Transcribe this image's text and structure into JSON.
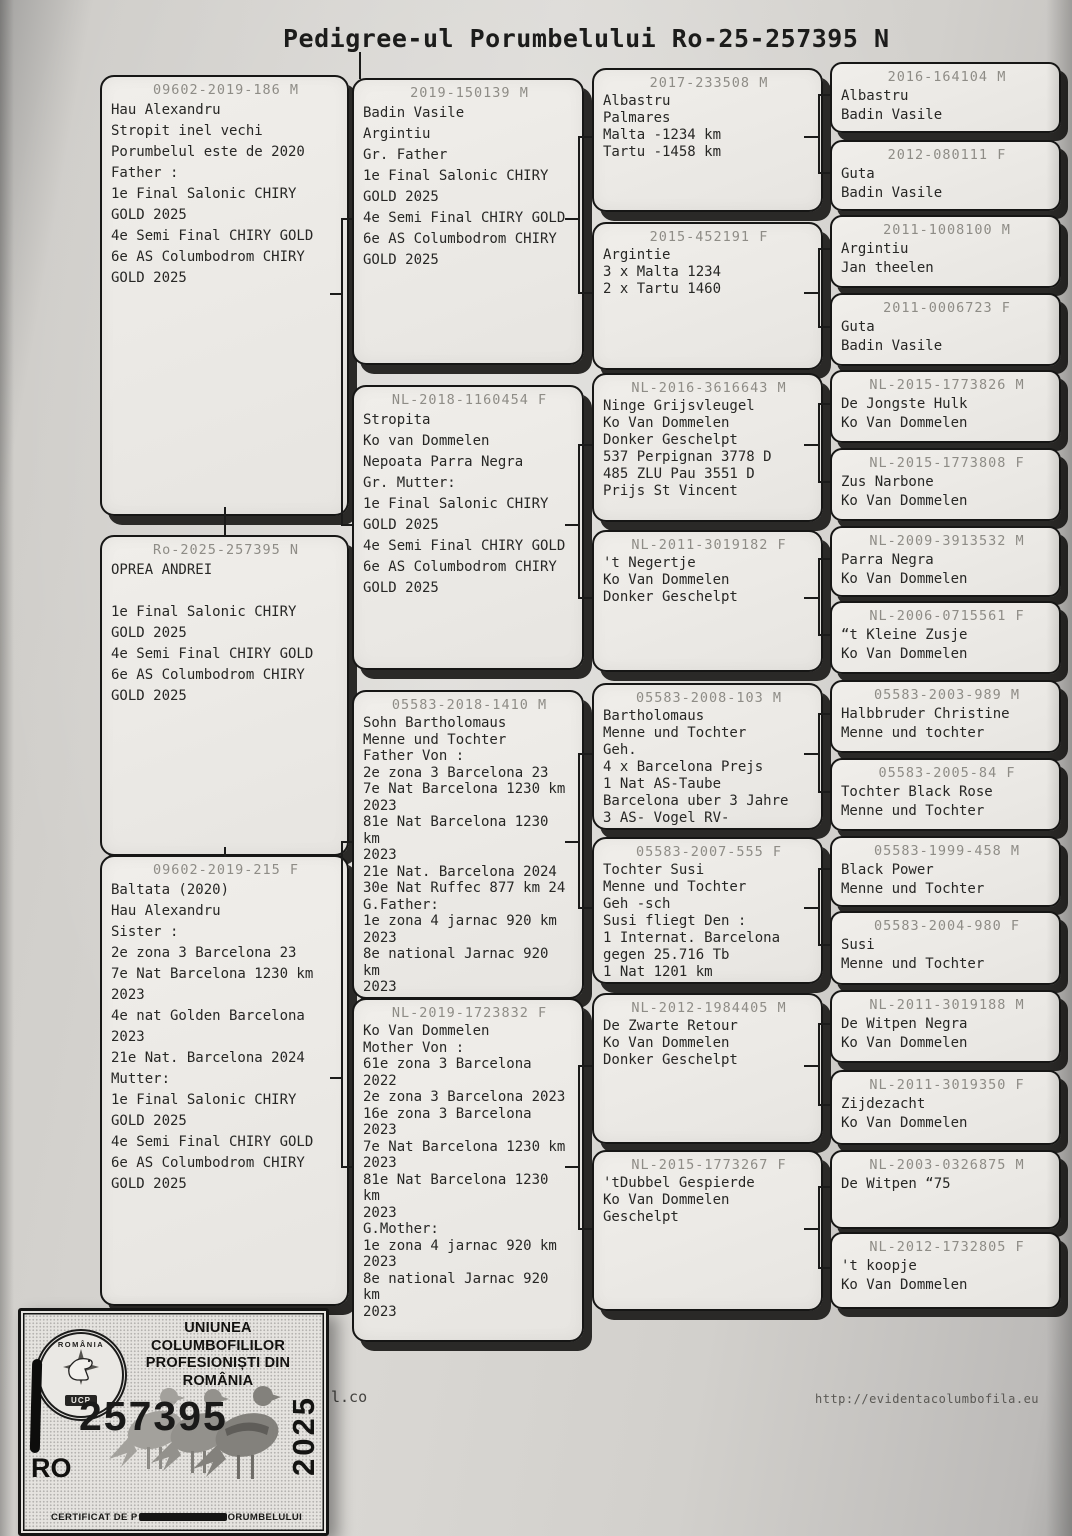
{
  "title": "Pedigree-ul Porumbelului Ro-25-257395 N",
  "boxes": {
    "father": {
      "ring": "09602-2019-186 M",
      "lines": [
        "Hau Alexandru",
        "Stropit inel vechi",
        "Porumbelul este de 2020",
        "Father :",
        "1e Final Salonic CHIRY",
        "GOLD 2025",
        "4e Semi Final CHIRY GOLD",
        "6e AS Columbodrom CHIRY",
        "GOLD 2025"
      ]
    },
    "subject": {
      "ring": "Ro-2025-257395 N",
      "lines": [
        "OPREA ANDREI",
        "",
        "1e Final Salonic CHIRY",
        "GOLD 2025",
        "4e Semi Final CHIRY GOLD",
        "6e AS Columbodrom CHIRY",
        "GOLD 2025"
      ]
    },
    "mother": {
      "ring": "09602-2019-215 F",
      "lines": [
        "Baltata (2020)",
        "Hau Alexandru",
        "Sister :",
        "2e zona 3 Barcelona 23",
        "7e Nat Barcelona 1230 km",
        "2023",
        "4e nat Golden Barcelona",
        "2023",
        "21e Nat. Barcelona 2024",
        "Mutter:",
        "1e Final Salonic CHIRY",
        "GOLD 2025",
        "4e Semi Final CHIRY GOLD",
        "6e AS Columbodrom CHIRY",
        "GOLD 2025"
      ]
    },
    "gp": [
      {
        "ring": "2019-150139 M",
        "lines": [
          "Badin Vasile",
          "Argintiu",
          "Gr. Father",
          "1e Final Salonic CHIRY",
          "GOLD 2025",
          "4e Semi Final CHIRY GOLD",
          "6e AS Columbodrom CHIRY",
          "GOLD 2025"
        ]
      },
      {
        "ring": "NL-2018-1160454 F",
        "lines": [
          "Stropita",
          "Ko van Dommelen",
          "Nepoata Parra Negra",
          "Gr. Mutter:",
          "1e Final Salonic CHIRY",
          "GOLD 2025",
          "4e Semi Final CHIRY GOLD",
          "6e AS Columbodrom CHIRY",
          "GOLD 2025"
        ]
      },
      {
        "ring": "05583-2018-1410 M",
        "lines": [
          "Sohn Bartholomaus",
          "Menne und Tochter",
          "Father Von :",
          "2e zona 3 Barcelona 23",
          "7e Nat Barcelona 1230 km",
          "2023",
          "81e Nat Barcelona 1230",
          "km",
          "2023",
          "21e Nat. Barcelona 2024",
          "30e Nat Ruffec 877 km 24",
          "G.Father:",
          "1e zona 4 jarnac 920 km",
          "2023",
          "8e national Jarnac 920",
          "km",
          "2023"
        ]
      },
      {
        "ring": "NL-2019-1723832 F",
        "lines": [
          "Ko Van Dommelen",
          "Mother Von :",
          "61e zona 3 Barcelona",
          "2022",
          "2e zona 3 Barcelona 2023",
          "16e zona 3 Barcelona",
          "2023",
          "7e Nat Barcelona 1230 km",
          "2023",
          "81e Nat Barcelona 1230",
          "km",
          "2023",
          "G.Mother:",
          "1e zona 4 jarnac 920 km",
          "2023",
          "8e national Jarnac 920",
          "km",
          "2023"
        ]
      }
    ],
    "ggp": [
      {
        "ring": "2017-233508 M",
        "lines": [
          "Albastru",
          "Palmares",
          "Malta -1234 km",
          "Tartu -1458 km"
        ]
      },
      {
        "ring": "2015-452191 F",
        "lines": [
          "Argintie",
          "3 x Malta 1234",
          "2 x Tartu 1460"
        ]
      },
      {
        "ring": "NL-2016-3616643 M",
        "lines": [
          "Ninge Grijsvleugel",
          "Ko Van Dommelen",
          "Donker Geschelpt",
          "537 Perpignan 3778 D",
          "485 ZLU Pau 3551 D",
          "Prijs St Vincent"
        ]
      },
      {
        "ring": "NL-2011-3019182 F",
        "lines": [
          "'t Negertje",
          "Ko Van Dommelen",
          "Donker Geschelpt"
        ]
      },
      {
        "ring": "05583-2008-103 M",
        "lines": [
          "Bartholomaus",
          "Menne und Tochter",
          "Geh.",
          "4 x Barcelona Prejs",
          "1 Nat AS-Taube",
          "Barcelona uber 3 Jahre",
          "3 AS- Vogel RV-"
        ]
      },
      {
        "ring": "05583-2007-555 F",
        "lines": [
          "Tochter Susi",
          "Menne und Tochter",
          "Geh -sch",
          "Susi fliegt Den :",
          "1 Internat. Barcelona",
          "gegen 25.716 Tb",
          "1 Nat 1201 km"
        ]
      },
      {
        "ring": "NL-2012-1984405 M",
        "lines": [
          "De Zwarte Retour",
          "Ko Van Dommelen",
          "Donker Geschelpt"
        ]
      },
      {
        "ring": "NL-2015-1773267 F",
        "lines": [
          "'tDubbel Gespierde",
          "Ko Van Dommelen",
          "Geschelpt"
        ]
      }
    ],
    "gggp": [
      {
        "ring": "2016-164104 M",
        "lines": [
          "Albastru",
          "Badin Vasile"
        ]
      },
      {
        "ring": "2012-080111 F",
        "lines": [
          "Guta",
          "Badin Vasile"
        ]
      },
      {
        "ring": "2011-1008100 M",
        "lines": [
          "Argintiu",
          "Jan theelen"
        ]
      },
      {
        "ring": "2011-0006723 F",
        "lines": [
          "Guta",
          "Badin Vasile"
        ]
      },
      {
        "ring": "NL-2015-1773826 M",
        "lines": [
          "De Jongste Hulk",
          "Ko Van Dommelen"
        ]
      },
      {
        "ring": "NL-2015-1773808 F",
        "lines": [
          "Zus Narbone",
          "Ko Van Dommelen"
        ]
      },
      {
        "ring": "NL-2009-3913532 M",
        "lines": [
          "Parra Negra",
          "Ko Van Dommelen"
        ]
      },
      {
        "ring": "NL-2006-0715561 F",
        "lines": [
          "“t Kleine Zusje",
          "Ko Van Dommelen"
        ]
      },
      {
        "ring": "05583-2003-989 M",
        "lines": [
          "Halbbruder Christine",
          "Menne und tochter"
        ]
      },
      {
        "ring": "05583-2005-84 F",
        "lines": [
          "Tochter Black Rose",
          "Menne und Tochter"
        ]
      },
      {
        "ring": "05583-1999-458 M",
        "lines": [
          "Black Power",
          "Menne und Tochter"
        ]
      },
      {
        "ring": "05583-2004-980 F",
        "lines": [
          "Susi",
          "Menne und Tochter"
        ]
      },
      {
        "ring": "NL-2011-3019188 M",
        "lines": [
          "De Witpen Negra",
          "Ko Van Dommelen"
        ]
      },
      {
        "ring": "NL-2011-3019350 F",
        "lines": [
          "Zijdezacht",
          "Ko Van Dommelen"
        ]
      },
      {
        "ring": "NL-2003-0326875 M",
        "lines": [
          "De Witpen “75"
        ]
      },
      {
        "ring": "NL-2012-1732805 F",
        "lines": [
          "'t koopje",
          "Ko Van Dommelen"
        ]
      }
    ]
  },
  "stamp": {
    "org_line1": "UNIUNEA COLUMBOFILILOR",
    "org_line2": "PROFESIONIȘTI DIN ROMÂNIA",
    "number": "257395",
    "country": "RO",
    "year": "2025",
    "cert_prefix": "CERTIFICAT DE P",
    "cert_suffix": "ORUMBELULUI",
    "logo_top": "ROMÂNIA",
    "logo_bottom": "UCP"
  },
  "footer": {
    "partial_url": "l.co",
    "url": "http://evidentacolumbofila.eu"
  }
}
